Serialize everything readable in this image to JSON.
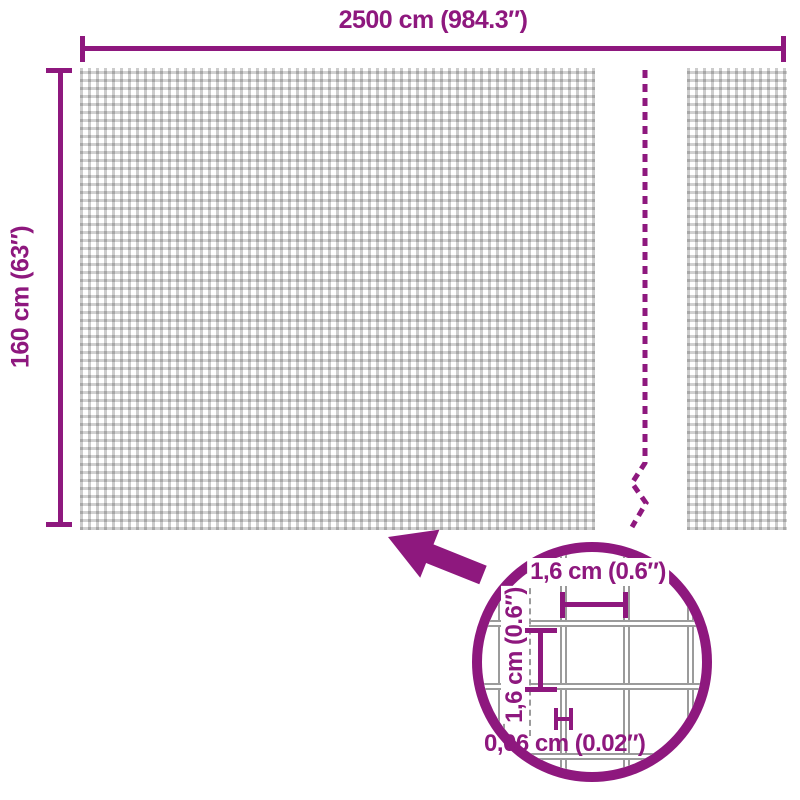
{
  "diagram": {
    "type": "product-dimension-diagram",
    "colors": {
      "accent": "#8E187E",
      "mesh_grid_gray": "#C6C6C6",
      "wire_gray": "#9B9B9B",
      "background": "#FFFFFF"
    },
    "overall": {
      "width_label": "2500 cm (984.3″)",
      "height_label": "160 cm (63″)"
    },
    "detail_view": {
      "mesh_width_label": "1,6 cm (0.6″)",
      "mesh_height_label": "1,6 cm (0.6″)",
      "wire_thickness_label": "0,06 cm (0.02″)"
    },
    "icons": {
      "zoom_arrow": "thick arrow pointing up-left from detail circle to mesh",
      "break_line": "vertical dashed line with zigzag indicating continued length",
      "detail_circle": "magnifier circle showing enlarged mesh"
    }
  }
}
